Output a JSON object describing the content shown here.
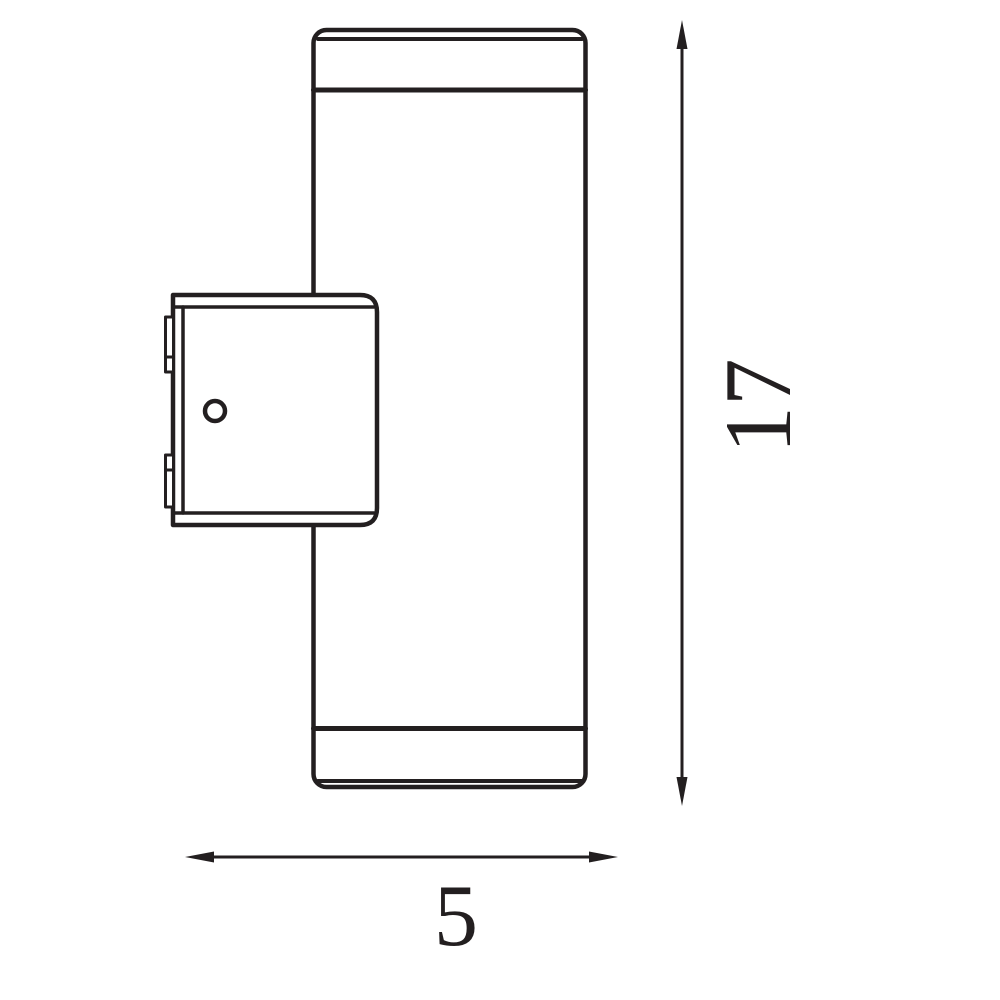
{
  "drawing": {
    "type": "technical-dimension-drawing",
    "subject": "wall-luminaire-side-view",
    "background_color": "#ffffff",
    "line_color": "#231f20",
    "dimensions": {
      "height": {
        "label": "17"
      },
      "width": {
        "label": "5"
      }
    }
  }
}
